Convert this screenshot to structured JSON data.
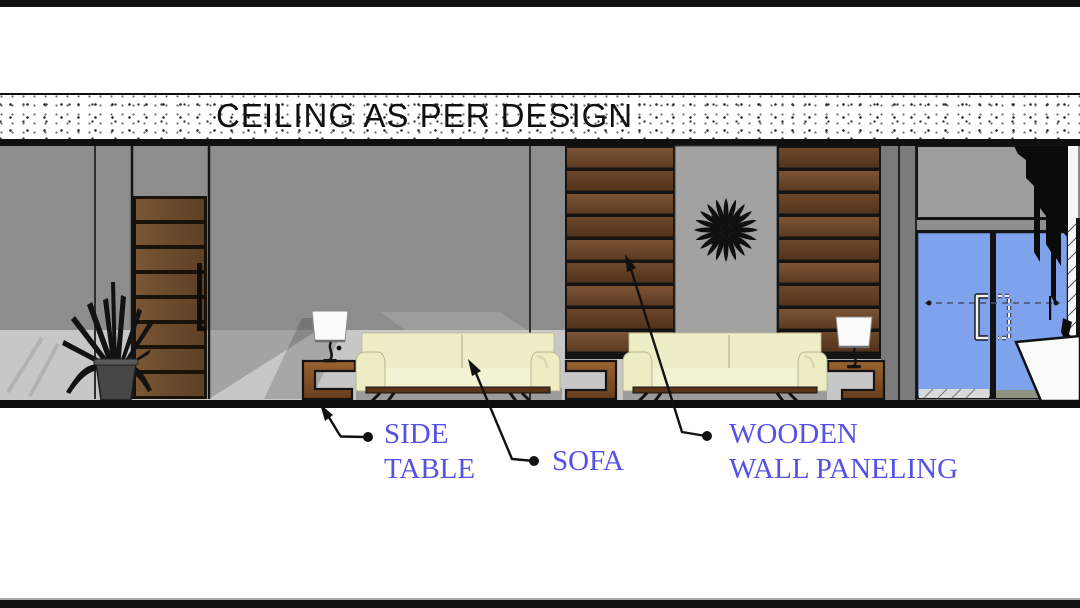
{
  "drawing": {
    "type": "interior-elevation",
    "title": "CEILING AS PER DESIGN",
    "annotations": [
      {
        "id": "side_table",
        "line1": "SIDE",
        "line2": "TABLE"
      },
      {
        "id": "sofa",
        "line1": "SOFA",
        "line2": ""
      },
      {
        "id": "wall_paneling",
        "line1": "WOODEN",
        "line2": "WALL PANELING"
      }
    ],
    "elements": [
      "wooden-door",
      "potted-plant",
      "side-table-1",
      "table-lamp-1",
      "sofa-1",
      "side-table-middle",
      "sofa-2",
      "table-lamp-2",
      "side-table-2",
      "wooden-wall-paneling",
      "sunburst-wall-art",
      "glass-double-door",
      "reception-counter"
    ],
    "colors": {
      "label_text": "#5551e8",
      "glass_blue": "#7fa2ec",
      "wall_gray": "#8d8d8d",
      "floor_gray": "#c7c7c7",
      "wood_dark": "#5d3a20",
      "wood_mid": "#7a5130",
      "sofa_cream": "#eeedc5",
      "line_black": "#111111",
      "ceiling_band": "#ffffff"
    }
  }
}
